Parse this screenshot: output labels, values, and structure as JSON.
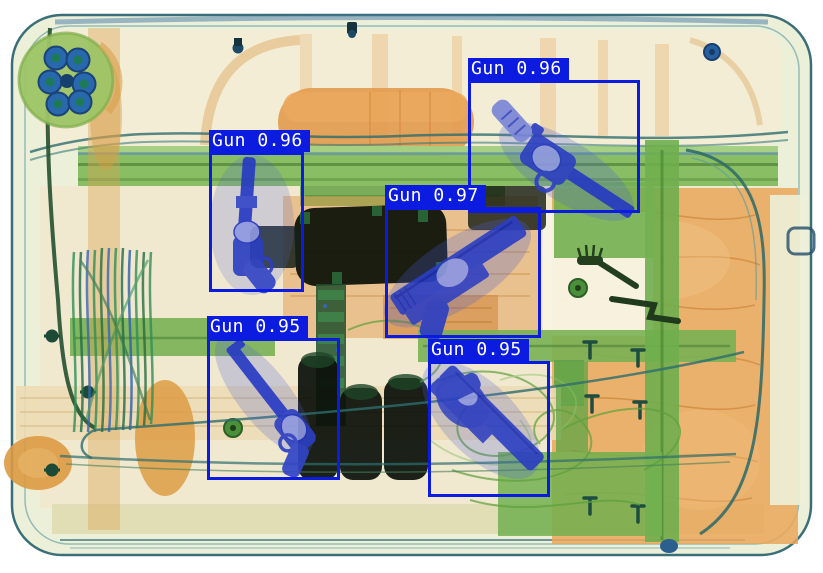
{
  "scene": {
    "description": "X-ray baggage scan of a suitcase containing detected handguns",
    "detector_class": "Gun"
  },
  "overlay": {
    "box_color": "#0b1ce0",
    "label_bg": "#0b1ce0",
    "label_text_color": "#ffffff"
  },
  "palette": {
    "background": "#ffffff",
    "shell": "#edf0d8",
    "shell_outline": "#3a6f7a",
    "organic_orange": "#e29a4c",
    "clothing_orange": "#e9a75a",
    "frame_green": "#85bb5e",
    "metal_gun_blue": "#2c3fc2",
    "metal_light_blue": "#8d97e0",
    "dense_black": "#0d1209",
    "wheel_green": "#9cc465",
    "bolt_blue": "#2263b0"
  },
  "detections": [
    {
      "id": 1,
      "label": "Gun",
      "confidence": 0.96,
      "display": "Gun 0.96",
      "box": {
        "x": 468,
        "y": 80,
        "w": 172,
        "h": 133
      }
    },
    {
      "id": 2,
      "label": "Gun",
      "confidence": 0.96,
      "display": "Gun 0.96",
      "box": {
        "x": 209,
        "y": 152,
        "w": 95,
        "h": 140
      }
    },
    {
      "id": 3,
      "label": "Gun",
      "confidence": 0.97,
      "display": "Gun 0.97",
      "box": {
        "x": 385,
        "y": 207,
        "w": 156,
        "h": 131
      }
    },
    {
      "id": 4,
      "label": "Gun",
      "confidence": 0.95,
      "display": "Gun 0.95",
      "box": {
        "x": 207,
        "y": 338,
        "w": 133,
        "h": 142
      }
    },
    {
      "id": 5,
      "label": "Gun",
      "confidence": 0.95,
      "display": "Gun 0.95",
      "box": {
        "x": 428,
        "y": 361,
        "w": 122,
        "h": 136
      }
    }
  ]
}
